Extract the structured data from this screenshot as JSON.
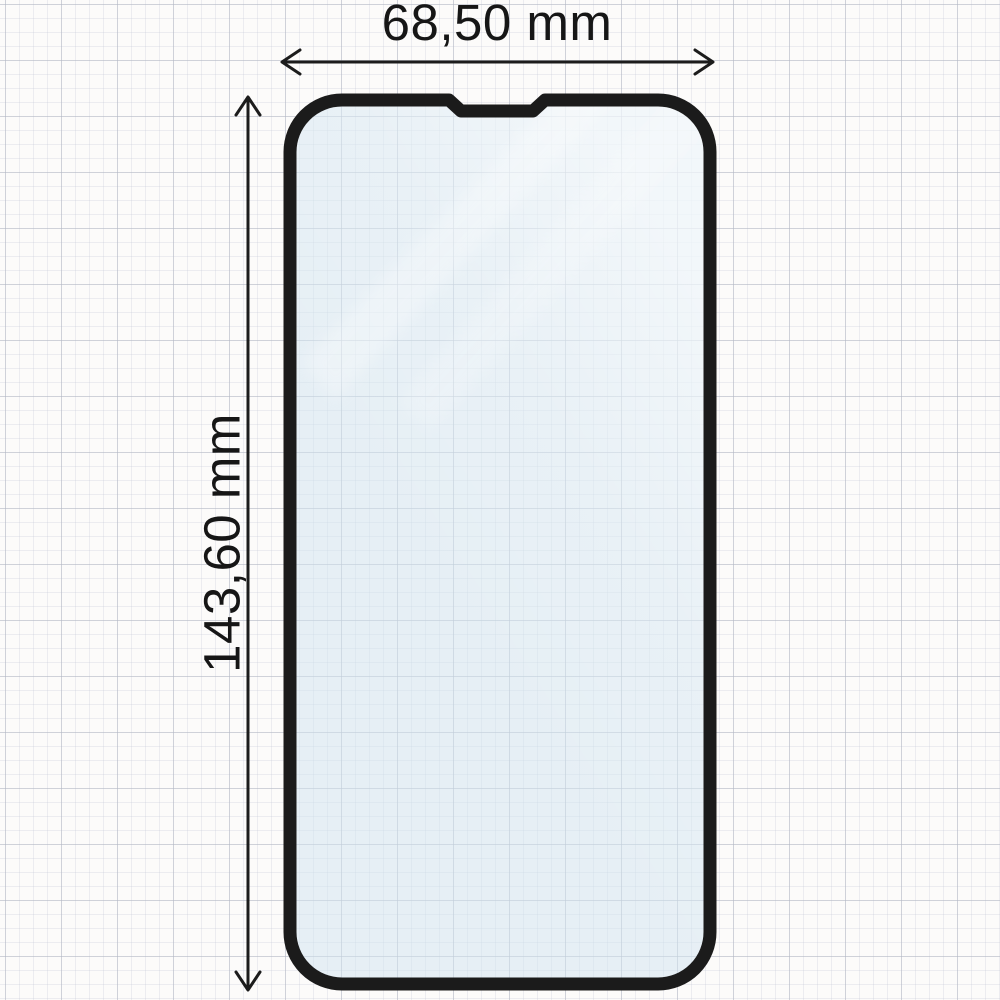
{
  "diagram": {
    "type": "product-dimension-diagram",
    "subject": "phone-screen-protector-front-view",
    "dimensions": {
      "width": {
        "label": "68,50 mm",
        "value": 68.5,
        "unit": "mm",
        "decimal_separator": ","
      },
      "height": {
        "label": "143,60 mm",
        "value": 143.6,
        "unit": "mm",
        "decimal_separator": ","
      }
    },
    "icons": {
      "width_arrow": "horizontal-double-arrow",
      "height_arrow": "vertical-double-arrow"
    },
    "colors": {
      "outline": "#1b1b1b",
      "dimension_line": "#1c1c1c",
      "label_text": "#161616",
      "glass_tint": "#dcebf4",
      "paper": "#fcfbfa",
      "grid_minor": "#e4e7ec",
      "grid_major": "#c9cdd6"
    }
  }
}
